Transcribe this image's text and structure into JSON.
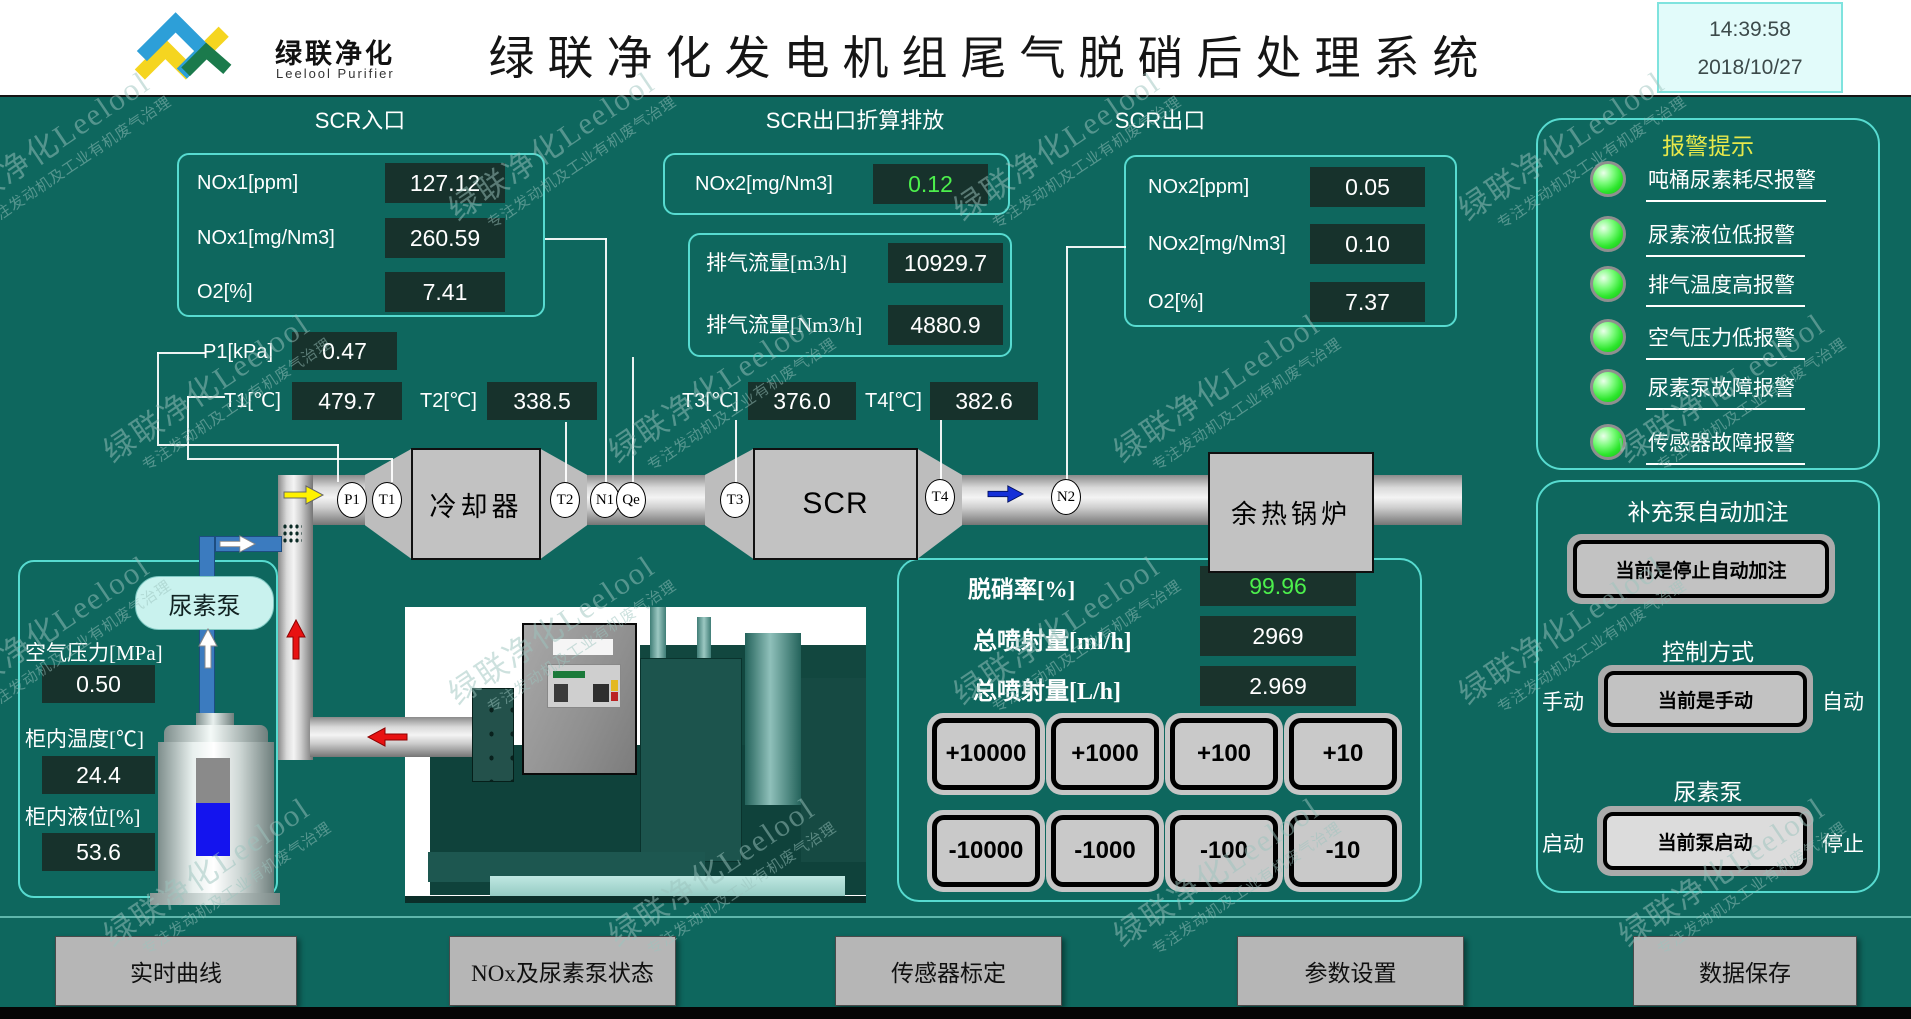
{
  "header": {
    "logo_cn": "绿联净化",
    "logo_en": "Leelool Purifier",
    "title": "绿联净化发电机组尾气脱硝后处理系统",
    "time": "14:39:58",
    "date": "2018/10/27"
  },
  "scr_inlet": {
    "title": "SCR入口",
    "rows": [
      {
        "label": "NOx1[ppm]",
        "value": "127.12"
      },
      {
        "label": "NOx1[mg/Nm3]",
        "value": "260.59"
      },
      {
        "label": "O2[%]",
        "value": "7.41"
      }
    ]
  },
  "scr_outlet_converted": {
    "title": "SCR出口折算排放",
    "nox_label": "NOx2[mg/Nm3]",
    "nox_value": "0.12",
    "flow_rows": [
      {
        "label": "排气流量[m3/h]",
        "value": "10929.7"
      },
      {
        "label": "排气流量[Nm3/h]",
        "value": "4880.9"
      }
    ]
  },
  "scr_outlet": {
    "title": "SCR出口",
    "rows": [
      {
        "label": "NOx2[ppm]",
        "value": "0.05"
      },
      {
        "label": "NOx2[mg/Nm3]",
        "value": "0.10"
      },
      {
        "label": "O2[%]",
        "value": "7.37"
      }
    ]
  },
  "sensors": {
    "p1_label": "P1[kPa]",
    "p1_value": "0.47",
    "t1_label": "T1[℃]",
    "t1_value": "479.7",
    "t2_label": "T2[℃]",
    "t2_value": "338.5",
    "t3_label": "T3[℃]",
    "t3_value": "376.0",
    "t4_label": "T4[℃]",
    "t4_value": "382.6"
  },
  "pipeline": {
    "tags": [
      "P1",
      "T1",
      "T2",
      "N1",
      "Qe",
      "T3",
      "T4",
      "N2"
    ],
    "cooler": "冷却器",
    "scr": "SCR",
    "boiler": "余热锅炉"
  },
  "urea": {
    "pump_label": "尿素泵",
    "air_pressure_label": "空气压力[MPa]",
    "air_pressure": "0.50",
    "cabinet_temp_label": "柜内温度[℃]",
    "cabinet_temp": "24.4",
    "cabinet_level_label": "柜内液位[%]",
    "cabinet_level": "53.6"
  },
  "injection": {
    "denox_label": "脱硝率[%]",
    "denox_value": "99.96",
    "ml_label": "总喷射量[ml/h]",
    "ml_value": "2969",
    "l_label": "总喷射量[L/h]",
    "l_value": "2.969",
    "increments": [
      "+10000",
      "+1000",
      "+100",
      "+10"
    ],
    "decrements": [
      "-10000",
      "-1000",
      "-100",
      "-10"
    ]
  },
  "alarms": {
    "title": "报警提示",
    "items": [
      "吨桶尿素耗尽报警",
      "尿素液位低报警",
      "排气温度高报警",
      "空气压力低报警",
      "尿素泵故障报警",
      "传感器故障报警"
    ]
  },
  "controls": {
    "refill_title": "补充泵自动加注",
    "refill_button": "当前是停止自动加注",
    "mode_title": "控制方式",
    "mode_left": "手动",
    "mode_button": "当前是手动",
    "mode_right": "自动",
    "pump_title": "尿素泵",
    "pump_left": "启动",
    "pump_button": "当前泵启动",
    "pump_right": "停止"
  },
  "nav": {
    "buttons": [
      "实时曲线",
      "NOx及尿素泵状态",
      "传感器标定",
      "参数设置",
      "数据保存"
    ]
  },
  "watermark": {
    "line1": "绿联净化Leelool",
    "line2": "专注发动机及工业有机废气治理"
  },
  "colors": {
    "background": "#0E675E",
    "panel_border": "#57DBD0",
    "value_green": "#4CF04C",
    "alarm_title_yellow": "#E8E84A"
  }
}
